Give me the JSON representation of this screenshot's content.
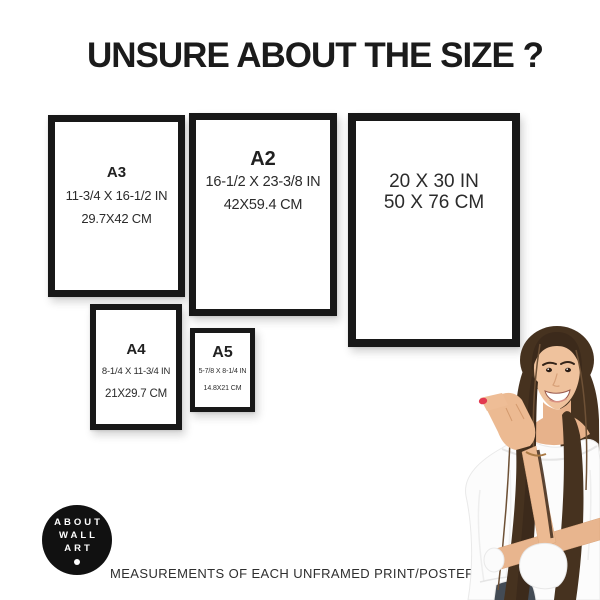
{
  "page": {
    "title": "UNSURE ABOUT THE SIZE ?",
    "caption": "MEASUREMENTS OF EACH UNFRAMED PRINT/POSTER",
    "background_color": "#ffffff"
  },
  "frames": [
    {
      "id": "a3",
      "label": "A3",
      "inches": "11-3/4 X 16-1/2 IN",
      "cm": "29.7X42 CM"
    },
    {
      "id": "a2",
      "label": "A2",
      "inches": "16-1/2 X 23-3/8 IN",
      "cm": "42X59.4 CM"
    },
    {
      "id": "20x30",
      "label": "",
      "inches": "20 X 30 IN",
      "cm": "50 X 76 CM"
    },
    {
      "id": "a4",
      "label": "A4",
      "inches": "8-1/4 X 11-3/4 IN",
      "cm": "21X29.7 CM"
    },
    {
      "id": "a5",
      "label": "A5",
      "inches": "5-7/8 X 8-1/4 IN",
      "cm": "14.8X21 CM"
    }
  ],
  "logo": {
    "lines": [
      "ABOUT",
      "WALL",
      "ART"
    ],
    "background": "#111111",
    "foreground": "#ffffff"
  },
  "photo": {
    "subject": "smiling woman with long brown hair pointing at the size chart",
    "hair_color": "#46321f",
    "skin_color": "#ecba92",
    "top_color": "#fcfcfc",
    "nail_color": "#e23950",
    "jeans_color": "#434b55"
  },
  "colors": {
    "frame_border": "#181818",
    "title_text": "#1b1b1b",
    "dimension_text": "#2b2b2b"
  }
}
